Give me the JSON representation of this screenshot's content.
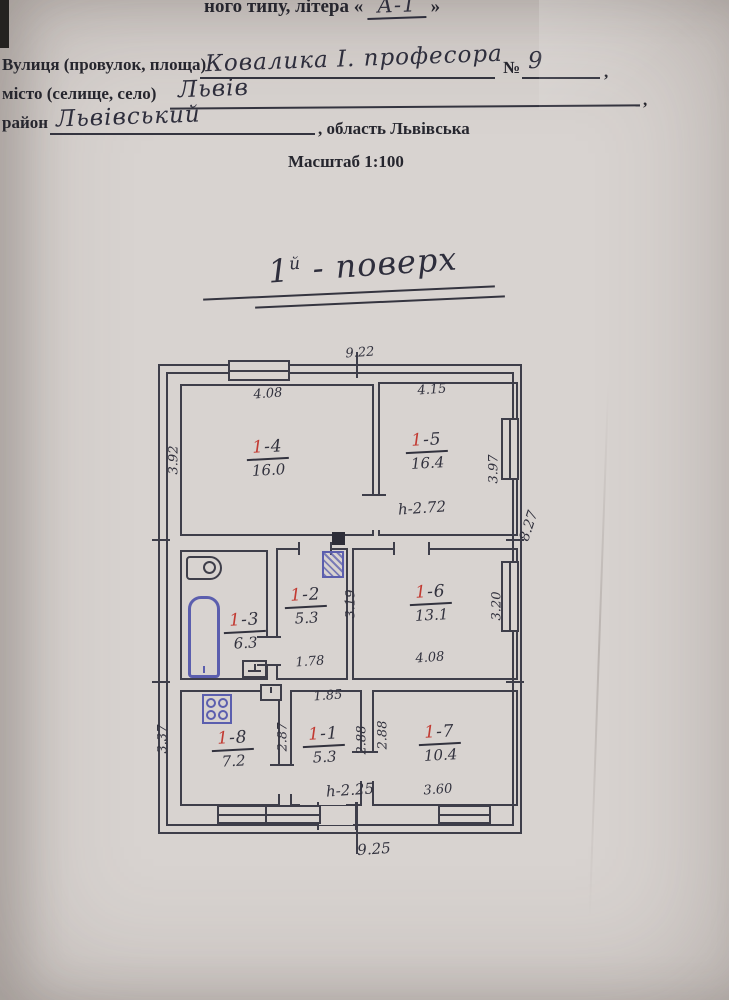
{
  "form": {
    "type_prefix": "ного типу, літера «",
    "type_value": "А-1",
    "type_suffix": "»",
    "street_label": "Вулиця (провулок, площа)",
    "street_value": "Ковалика І. професора",
    "number_label": "№",
    "number_value": "9",
    "street_comma": ",",
    "city_label": "місто (селище, село)",
    "city_value": "Львів",
    "city_comma": ",",
    "district_label": "район",
    "district_value": "Львівський",
    "region_label": ", область Львівська",
    "scale": "Масштаб 1:100"
  },
  "plan": {
    "title": {
      "num": "1",
      "sup": "й",
      "rest": "- поверх"
    },
    "overall": {
      "top": "9.22",
      "right": "8.27",
      "bottom": "9.25"
    },
    "rooms": [
      {
        "name": "room-1-4",
        "num_red": "1",
        "num_rest": "-4",
        "area": "16.0",
        "dim_top": "4.08",
        "dim_left": "3.92"
      },
      {
        "name": "room-1-5",
        "num_red": "1",
        "num_rest": "-5",
        "area": "16.4",
        "dim_top": "4.15",
        "dim_right": "3.97",
        "height_note": "h-2.72"
      },
      {
        "name": "room-1-3",
        "num_red": "1",
        "num_rest": "-3",
        "area": "6.3"
      },
      {
        "name": "room-1-2",
        "num_red": "1",
        "num_rest": "-2",
        "area": "5.3",
        "dim_bottom": "1.78",
        "dim_right": "3.19"
      },
      {
        "name": "room-1-6",
        "num_red": "1",
        "num_rest": "-6",
        "area": "13.1",
        "dim_bottom": "4.08",
        "dim_right": "3.20"
      },
      {
        "name": "room-1-8",
        "num_red": "1",
        "num_rest": "-8",
        "area": "7.2",
        "dim_left": "3.37",
        "dim_right": "2.87"
      },
      {
        "name": "room-1-1",
        "num_red": "1",
        "num_rest": "-1",
        "area": "5.3",
        "dim_top": "1.85",
        "dim_left": "2.88",
        "dim_right": "2.88",
        "height_note": "h-2.25"
      },
      {
        "name": "room-1-7",
        "num_red": "1",
        "num_rest": "-7",
        "area": "10.4",
        "dim_bottom": "3.60"
      }
    ],
    "fixtures": [
      "bathtub-icon",
      "bath-sink-icon",
      "kitchen-sink-icon",
      "toilet-icon",
      "gas-stove-icon",
      "furnace-icon",
      "chimney-icon",
      "vent-shaft-icon"
    ]
  },
  "colors": {
    "paper": "#d8d3d0",
    "ink": "#3e3e4a",
    "handwriting": "#2e2e3c",
    "red": "#c23a32",
    "fixture_blue": "#5b5eae"
  }
}
